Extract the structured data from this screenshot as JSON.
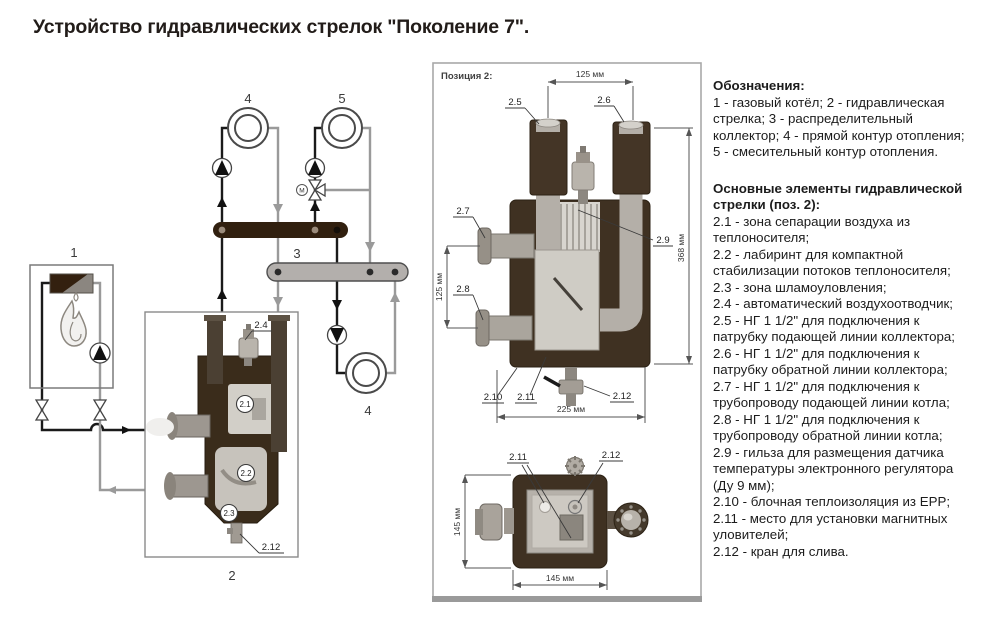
{
  "title": "Устройство гидравлических стрелок \"Поколение 7\".",
  "colors": {
    "insulation_brown": "#3f3122",
    "manifold_dark_brown": "#31200f",
    "manifold_gray": "#b3afac",
    "pipe_gray": "#b4afa8",
    "interior_light": "#cfccc5",
    "line_black": "#1a1a1a",
    "line_gray": "#9a9a9a"
  },
  "schematic": {
    "label_1": "1",
    "label_2": "2",
    "label_3": "3",
    "label_4a": "4",
    "label_4b": "4",
    "label_5": "5",
    "valve_motor": "M",
    "callout_21": "2.1",
    "callout_22": "2.2",
    "callout_23": "2.3",
    "callout_24": "2.4",
    "callout_212": "2.12"
  },
  "position_box": {
    "heading": "Позиция 2:",
    "main": {
      "c25": "2.5",
      "c26": "2.6",
      "c27": "2.7",
      "c28": "2.8",
      "c29": "2.9",
      "c210": "2.10",
      "c211": "2.11",
      "c212": "2.12",
      "dim_top": "125 мм",
      "dim_left": "125 мм",
      "dim_right": "368 мм",
      "dim_bottom": "225 мм"
    },
    "bottom": {
      "c211": "2.11",
      "c212": "2.12",
      "dim_left": "145 мм",
      "dim_bottom": "145 мм"
    }
  },
  "legend": {
    "heading1": "Обозначения:",
    "paragraph1": "1 - газовый котёл; 2 - гидравлическая стрелка; 3 - распределительный коллектор; 4 - прямой контур отопления; 5 - смесительный контур отопления.",
    "heading2": "Основные элементы гидравлической стрелки (поз. 2):",
    "items": [
      "2.1 - зона сепарации воздуха из теплоносителя;",
      "2.2 - лабиринт для компактной стабилизации потоков теплоносителя;",
      "2.3 - зона шламоуловления;",
      "2.4 - автоматический воздухоотводчик;",
      "2.5 - НГ 1 1/2\" для подключения к патрубку подающей линии коллектора;",
      "2.6 - НГ 1 1/2\" для подключения к патрубку обратной линии коллектора;",
      "2.7 - НГ 1 1/2\" для подключения к трубопроводу подающей линии котла;",
      "2.8 - НГ 1 1/2\" для подключения к трубопроводу обратной линии котла;",
      "2.9 - гильза для размещения датчика температуры электронного регулятора (Ду 9 мм);",
      "2.10 - блочная теплоизоляция из EPP;",
      "2.11 - место для установки магнитных уловителей;",
      "2.12 - кран для слива."
    ]
  }
}
